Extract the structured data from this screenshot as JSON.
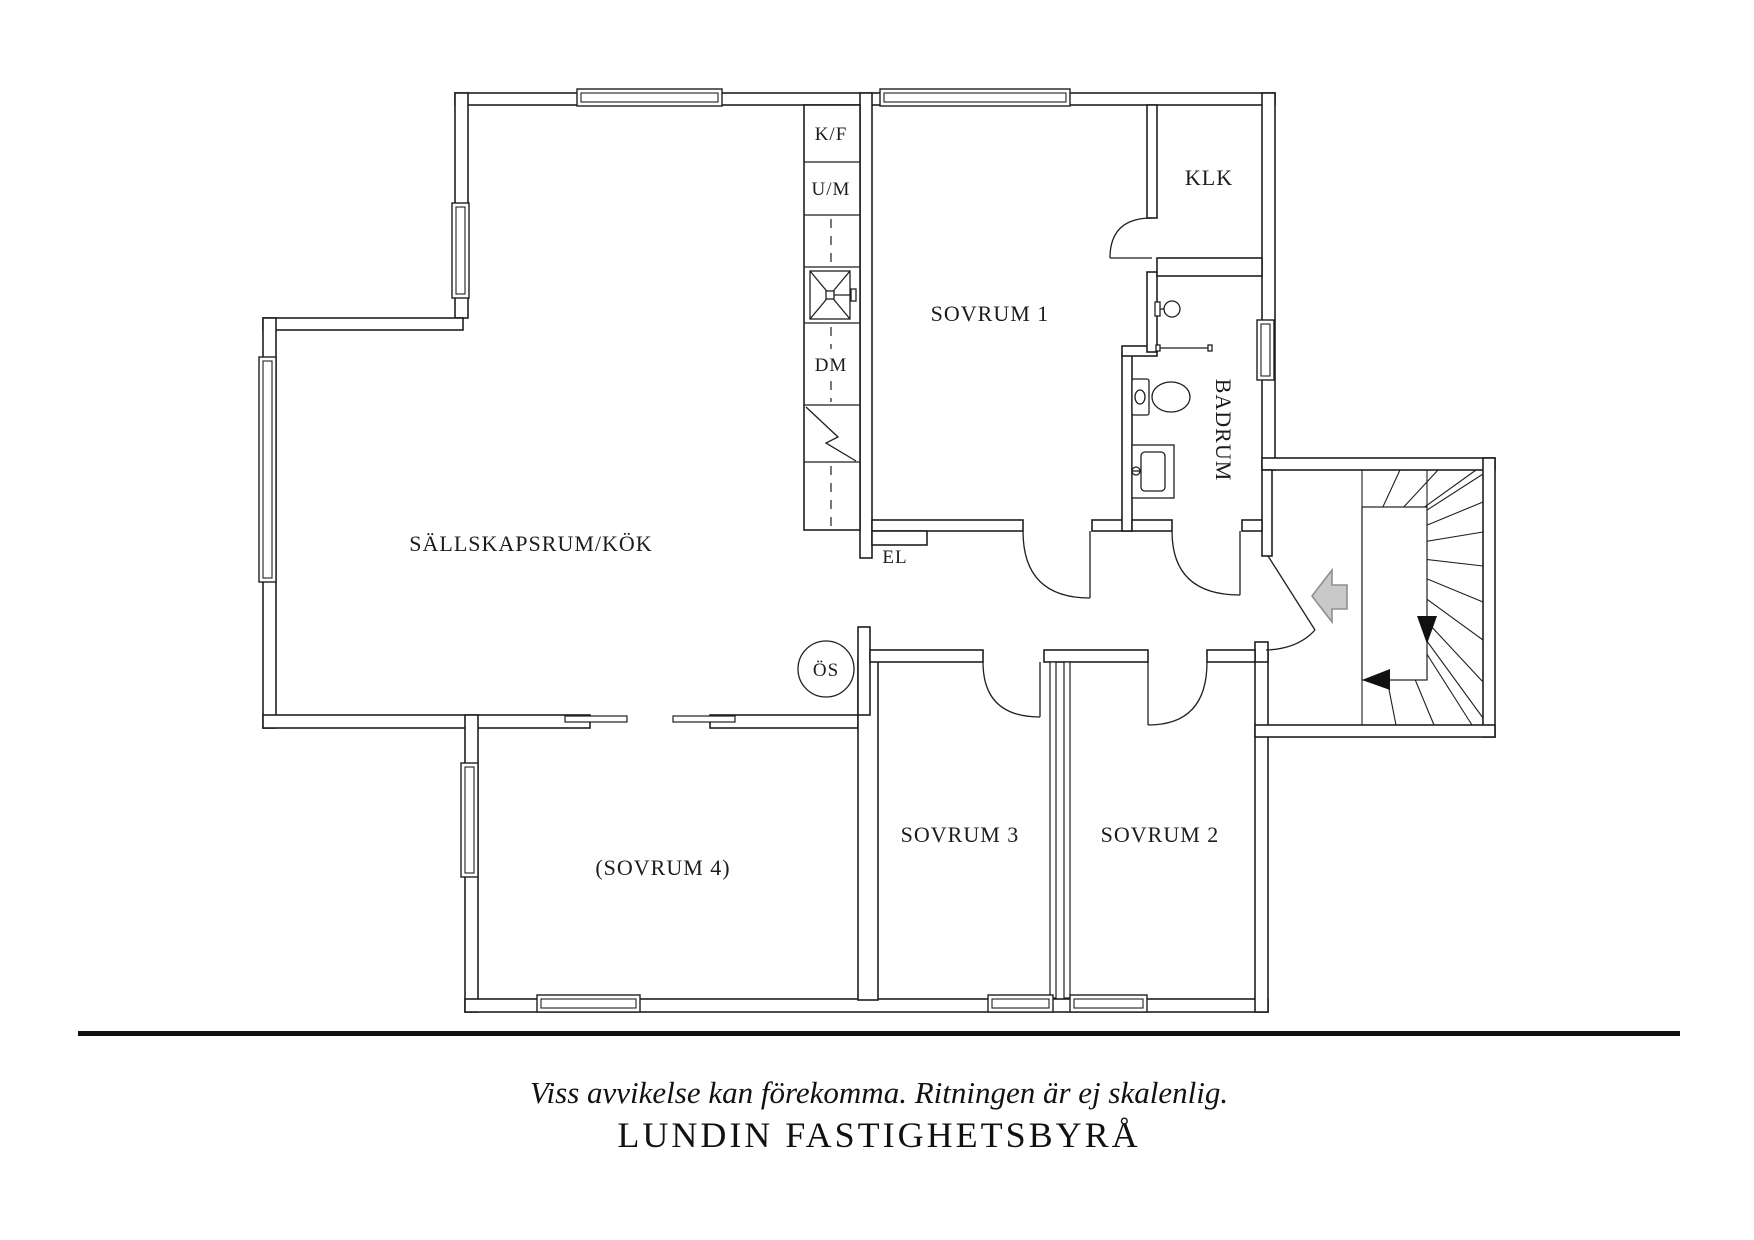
{
  "plan": {
    "rooms": {
      "living": "SÄLLSKAPSRUM/KÖK",
      "bedroom1": "SOVRUM 1",
      "bedroom2": "SOVRUM 2",
      "bedroom3": "SOVRUM 3",
      "bedroom4": "(SOVRUM 4)",
      "closet": "KLK",
      "bathroom": "BADRUM"
    },
    "labels": {
      "fridge_freezer": "K/F",
      "oven_micro": "U/M",
      "dishwasher": "DM",
      "electrical": "EL",
      "fireplace": "ÖS"
    }
  },
  "footer": {
    "disclaimer": "Viss avvikelse kan förekomma. Ritningen är ej skalenlig.",
    "brand": "LUNDIN FASTIGHETSBYRÅ"
  },
  "colors": {
    "line": "#1f1f1f",
    "entrance_arrow_fill": "#c9c9c9",
    "entrance_arrow_stroke": "#8f8f8f",
    "divider": "#111111",
    "background": "#ffffff"
  }
}
